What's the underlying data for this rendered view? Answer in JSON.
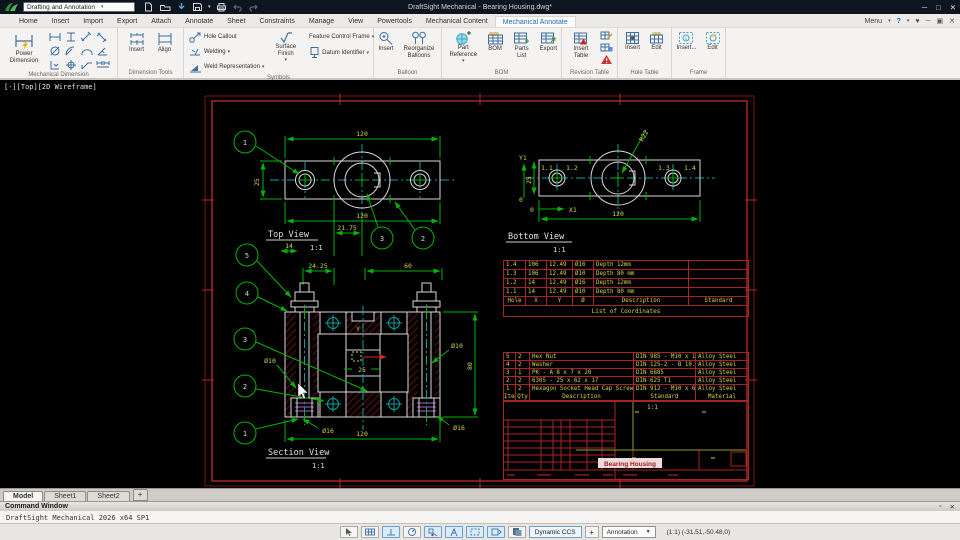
{
  "title_bar": {
    "workspace_selector": "Drafting and Annotation",
    "title": "DraftSight Mechanical - Bearing Housing.dwg*"
  },
  "ribbon": {
    "tabs": [
      "Home",
      "Insert",
      "Import",
      "Export",
      "Attach",
      "Annotate",
      "Sheet",
      "Constraints",
      "Manage",
      "View",
      "Powertools",
      "Mechanical Content",
      "Mechanical Annotate"
    ],
    "menu_label": "Menu",
    "help_label": "?",
    "groups": {
      "mechanical_dimension": {
        "label": "Mechanical Dimension",
        "power_dimension": "Power Dimension"
      },
      "dimension_tools": {
        "label": "Dimension Tools",
        "insert": "Insert",
        "align": "Align"
      },
      "symbols": {
        "label": "Symbols",
        "hole_callout": "Hole Callout",
        "welding": "Welding",
        "weld_representation": "Weld Representation",
        "surface_finish": "Surface Finish",
        "feature_control_frame": "Feature Control Frame",
        "datum_identifier": "Datum Identifier"
      },
      "balloon": {
        "label": "Balloon",
        "insert": "Insert",
        "reorganize": "Reorganize Balloons"
      },
      "bom": {
        "label": "BOM",
        "part_reference": "Part Reference",
        "bom": "BOM",
        "parts_list": "Parts List",
        "export": "Export"
      },
      "revision_table": {
        "label": "Revision Table",
        "insert_table": "Insert Table"
      },
      "hole_table": {
        "label": "Hole Table",
        "insert": "Insert",
        "edit": "Edit"
      },
      "frame": {
        "label": "Frame",
        "insert": "Insert...",
        "edit": "Edit"
      }
    }
  },
  "viewport_label": "[-][Top][2D Wireframe]",
  "drawing": {
    "top_view": {
      "title": "Top View",
      "scale": "1:1",
      "dim_top": "120",
      "dim_bottom": "120",
      "dim_left": "25",
      "dim_14": "14",
      "dim_2175": "21.75",
      "dim_2425": "24.25",
      "dim_60": "60",
      "balloon_1": "1",
      "balloon_2": "2",
      "balloon_3": "3"
    },
    "bottom_view": {
      "title": "Bottom View",
      "scale": "1:1",
      "dim_bottom": "120",
      "dim_left": "25",
      "radius": "R22",
      "axis_x": "X1",
      "axis_y": "Y1",
      "zero_x": "0",
      "zero_y": "0",
      "tag_11": "1.1",
      "tag_12": "1.2",
      "tag_13": "1.3",
      "tag_14": "1.4"
    },
    "section_view": {
      "title": "Section View",
      "scale": "1:1",
      "balloon_1": "1",
      "balloon_2": "2",
      "balloon_3": "3",
      "balloon_4": "4",
      "balloon_5": "5",
      "dia10_left": "Ø10",
      "dia16_left": "Ø16",
      "dia10_right": "Ø10",
      "dia16_right": "Ø16",
      "dim_80": "80",
      "dim_120": "120",
      "dim_25": "25",
      "ccs_y": "Y"
    }
  },
  "coordinate_table": {
    "title": "List of Coordinates",
    "headers": [
      "Hole",
      "X",
      "Y",
      "Ø",
      "Description",
      "Standard"
    ],
    "rows": [
      [
        "1.4",
        "106",
        "12.49",
        "Ø16",
        "Depth 12mm",
        ""
      ],
      [
        "1.3",
        "106",
        "12.49",
        "Ø10",
        "Depth 80 mm",
        ""
      ],
      [
        "1.2",
        "14",
        "12.49",
        "Ø16",
        "Depth 12mm",
        ""
      ],
      [
        "1.1",
        "14",
        "12.49",
        "Ø10",
        "Depth 80 mm",
        ""
      ]
    ]
  },
  "bom_table": {
    "headers": [
      "Item",
      "Qty",
      "Description",
      "Standard",
      "Material"
    ],
    "rows": [
      [
        "5",
        "2",
        "Hex Nut",
        "DIN 985 - M10 x 1",
        "Alloy Steel"
      ],
      [
        "4",
        "2",
        "Washer",
        "DIN 125-2 - B 10.5",
        "Alloy Steel"
      ],
      [
        "3",
        "1",
        "PK - A 8 x 7 x 20",
        "DIN 6885",
        "Alloy Steel"
      ],
      [
        "2",
        "2",
        "6305 - 25 x 62 x 17",
        "DIN 625 T1",
        "Alloy Steel"
      ],
      [
        "1",
        "2",
        "Hexagon Socket Head Cap Screw",
        "DIN 912 - M10 x 60",
        "Alloy Steel"
      ]
    ]
  },
  "title_block": {
    "scale": "1:1",
    "drawing_name": "Bearing Housing"
  },
  "sheet_tabs": {
    "tabs": [
      "Model",
      "Sheet1",
      "Sheet2"
    ],
    "add_label": "+"
  },
  "command_window": {
    "title": "Command Window",
    "output": "DraftSight Mechanical 2026  x64 SP1"
  },
  "status_bar": {
    "dynamic_ccs": "Dynamic CCS",
    "add": "+",
    "annotation_style": "Annotation",
    "readout": "(1:1)  (-31.51,-50.48,0)"
  }
}
